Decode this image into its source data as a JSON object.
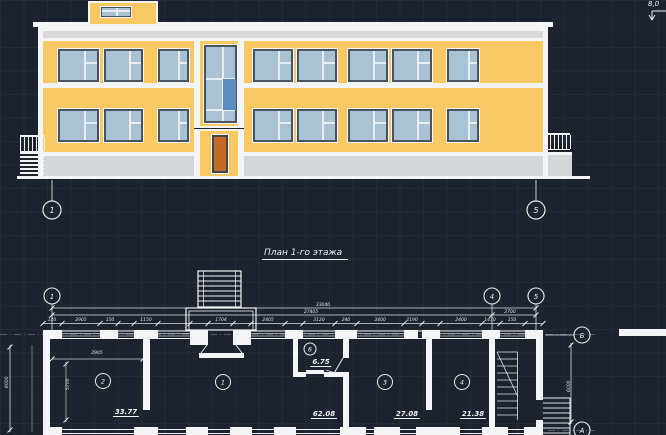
{
  "canvas": {
    "background": "#1c232e",
    "grid": "#232b36"
  },
  "colors": {
    "facade_yellow": "#f8c863",
    "window_blue": "#a9c3d4",
    "accent_pane_blue": "#5d8dc0",
    "door_orange": "#c46a24",
    "band_gray": "#d8dadc",
    "line_white": "#f2f4f6"
  },
  "elevation": {
    "axes": [
      "1",
      "5"
    ],
    "elevation_mark": "8,0"
  },
  "plan": {
    "title": "План 1-го этажа",
    "axes_top": [
      "1",
      "4",
      "5"
    ],
    "axes_right": [
      "Б",
      "А"
    ],
    "rooms": [
      {
        "num": "2",
        "area": "33.77"
      },
      {
        "num": "1",
        "area": "62.08"
      },
      {
        "num": "6",
        "area": "6.75"
      },
      {
        "num": "3",
        "area": "27.08"
      },
      {
        "num": "4",
        "area": "21.38"
      }
    ],
    "dims": {
      "overall_top": "33040",
      "overall_mid": "27405",
      "axis_4_5": "2700",
      "chain": [
        "120",
        "2905",
        "150",
        "1150",
        "1704",
        "2405",
        "3120",
        "240",
        "3400",
        "2190",
        "2400",
        "1470",
        "150"
      ],
      "room2_width": "2905",
      "room2_depth": "5700",
      "depth_left": "6000",
      "depth_right": "6000"
    }
  }
}
